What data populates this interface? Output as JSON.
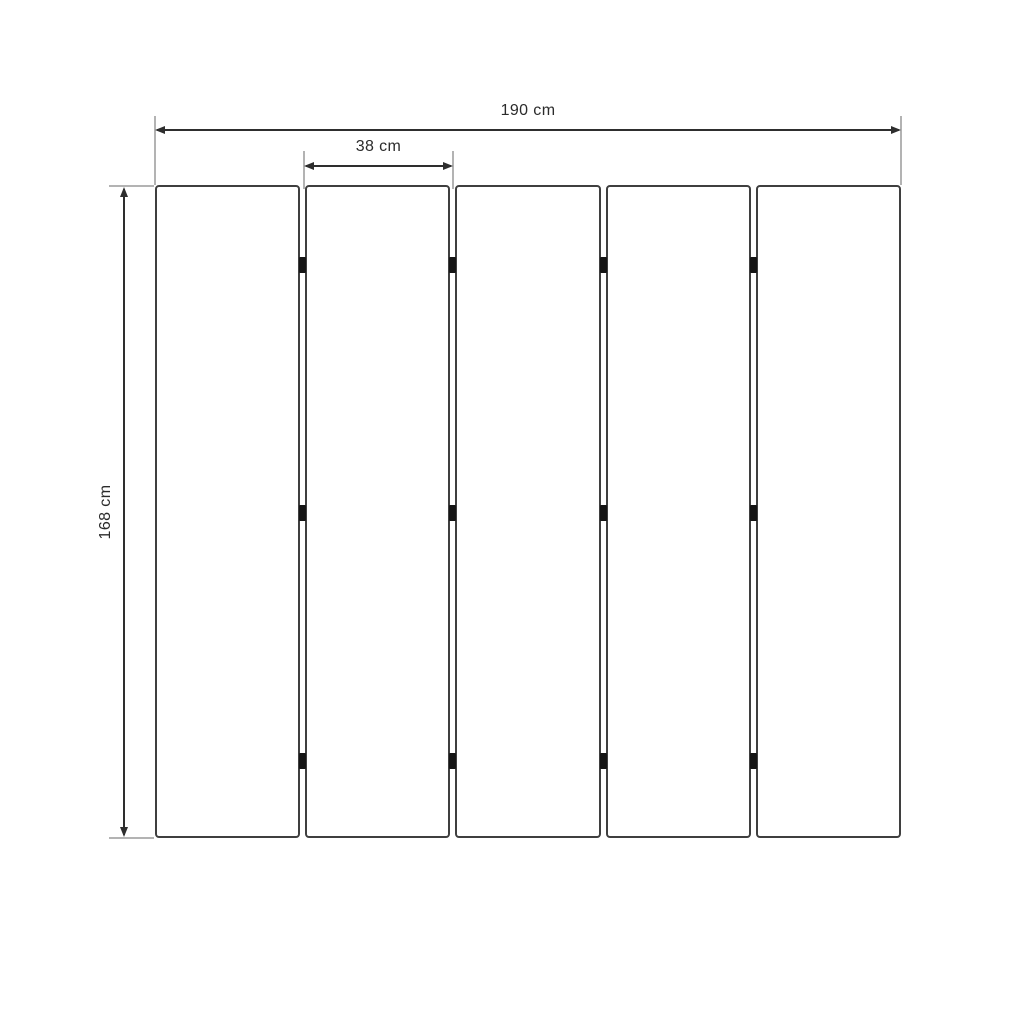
{
  "diagram": {
    "kind": "technical-dimension-drawing",
    "subject": "five vertical panels joined by hinges"
  },
  "dimensions": {
    "total_width": {
      "label": "190 cm",
      "value": 190,
      "unit": "cm"
    },
    "panel_width": {
      "label": "38 cm",
      "value": 38,
      "unit": "cm"
    },
    "height": {
      "label": "168 cm",
      "value": 168,
      "unit": "cm"
    }
  },
  "panels": {
    "count": 5,
    "joints": 4,
    "hinges_per_joint": 3
  },
  "colors": {
    "bg": "#ffffff",
    "panel_border": "#3f3f3f",
    "dim_line": "#2e2e2e",
    "ext_line": "#b3b3b3",
    "hinge": "#151515",
    "text": "#2b2b2b"
  }
}
